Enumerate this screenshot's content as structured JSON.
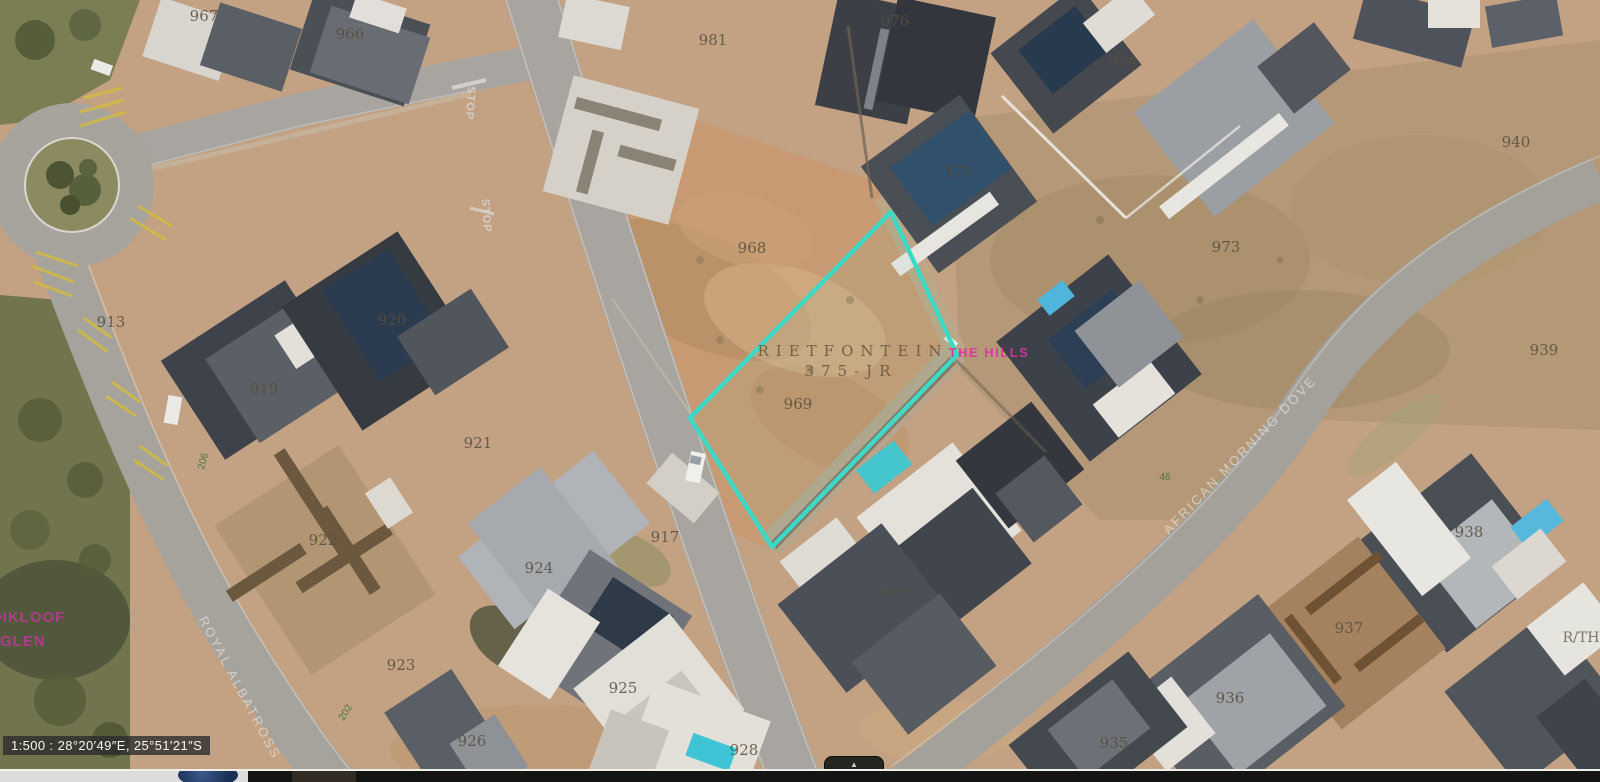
{
  "map": {
    "highlight_color": "#3ed8c6",
    "text_annotations": [
      {
        "text": "967",
        "x": 204,
        "y": 21,
        "rot": 0,
        "cls": "plot"
      },
      {
        "text": "966",
        "x": 350,
        "y": 39,
        "rot": 0,
        "cls": "plot"
      },
      {
        "text": "981",
        "x": 713,
        "y": 45,
        "rot": 0,
        "cls": "plot"
      },
      {
        "text": "976",
        "x": 895,
        "y": 26,
        "rot": 0,
        "cls": "plot"
      },
      {
        "text": "974",
        "x": 1123,
        "y": 67,
        "rot": 0,
        "cls": "plot"
      },
      {
        "text": "975",
        "x": 958,
        "y": 177,
        "rot": 0,
        "cls": "plot"
      },
      {
        "text": "940",
        "x": 1516,
        "y": 147,
        "rot": 0,
        "cls": "plot"
      },
      {
        "text": "973",
        "x": 1226,
        "y": 252,
        "rot": 0,
        "cls": "plot"
      },
      {
        "text": "939",
        "x": 1544,
        "y": 355,
        "rot": 0,
        "cls": "plot"
      },
      {
        "text": "968",
        "x": 752,
        "y": 253,
        "rot": 0,
        "cls": "plot"
      },
      {
        "text": "969",
        "x": 798,
        "y": 409,
        "rot": 0,
        "cls": "plot"
      },
      {
        "text": "913",
        "x": 111,
        "y": 327,
        "rot": 0,
        "cls": "plot"
      },
      {
        "text": "919",
        "x": 264,
        "y": 394,
        "rot": 0,
        "cls": "plot"
      },
      {
        "text": "920",
        "x": 392,
        "y": 325,
        "rot": 0,
        "cls": "plot"
      },
      {
        "text": "921",
        "x": 478,
        "y": 448,
        "rot": 0,
        "cls": "plot"
      },
      {
        "text": "922",
        "x": 323,
        "y": 545,
        "rot": 0,
        "cls": "plot"
      },
      {
        "text": "924",
        "x": 539,
        "y": 573,
        "rot": 0,
        "cls": "plot"
      },
      {
        "text": "917",
        "x": 665,
        "y": 542,
        "rot": 0,
        "cls": "plot"
      },
      {
        "text": "923",
        "x": 401,
        "y": 670,
        "rot": 0,
        "cls": "plot"
      },
      {
        "text": "925",
        "x": 623,
        "y": 693,
        "rot": 0,
        "cls": "plot"
      },
      {
        "text": "926",
        "x": 472,
        "y": 746,
        "rot": 0,
        "cls": "plot"
      },
      {
        "text": "970",
        "x": 894,
        "y": 598,
        "rot": 0,
        "cls": "plot"
      },
      {
        "text": "928",
        "x": 744,
        "y": 755,
        "rot": 0,
        "cls": "plot"
      },
      {
        "text": "935",
        "x": 1114,
        "y": 748,
        "rot": 0,
        "cls": "plot"
      },
      {
        "text": "936",
        "x": 1230,
        "y": 703,
        "rot": 0,
        "cls": "plot"
      },
      {
        "text": "937",
        "x": 1349,
        "y": 633,
        "rot": 0,
        "cls": "plot"
      },
      {
        "text": "938",
        "x": 1469,
        "y": 537,
        "rot": 0,
        "cls": "plot"
      },
      {
        "text": "RIETFONTEIN",
        "x": 853,
        "y": 356,
        "rot": 0,
        "cls": "region"
      },
      {
        "text": "375-JR",
        "x": 851,
        "y": 376,
        "rot": 0,
        "cls": "region"
      },
      {
        "text": "THE HILLS",
        "x": 989,
        "y": 357,
        "rot": 0,
        "cls": "estate"
      },
      {
        "text": "OIKLOOF",
        "x": -10,
        "y": 622,
        "rot": 0,
        "cls": "neigh"
      },
      {
        "text": "GLEN",
        "x": 0,
        "y": 646,
        "rot": 0,
        "cls": "neigh"
      },
      {
        "text": "ROYAL ALBATROSS",
        "x": 236,
        "y": 690,
        "rot": 62,
        "cls": "street"
      },
      {
        "text": "AFRICAN MORNING DOVE",
        "x": 1243,
        "y": 458,
        "rot": -46,
        "cls": "street"
      },
      {
        "text": "STOP",
        "x": 467,
        "y": 103,
        "rot": 94,
        "cls": "marking"
      },
      {
        "text": "STOP",
        "x": 483,
        "y": 216,
        "rot": 86,
        "cls": "marking"
      },
      {
        "text": "206",
        "x": 206,
        "y": 462,
        "rot": -75,
        "cls": "housenum"
      },
      {
        "text": "202",
        "x": 348,
        "y": 714,
        "rot": -58,
        "cls": "housenum"
      },
      {
        "text": "46",
        "x": 1165,
        "y": 480,
        "rot": 0,
        "cls": "housenum"
      },
      {
        "text": "R/TH",
        "x": 1581,
        "y": 642,
        "rot": 0,
        "cls": "partial"
      }
    ]
  },
  "status_bar": {
    "text": "1:500 : 28°20′49″E, 25°51′21″S"
  },
  "pullup_tab": {
    "arrow": "▲"
  }
}
